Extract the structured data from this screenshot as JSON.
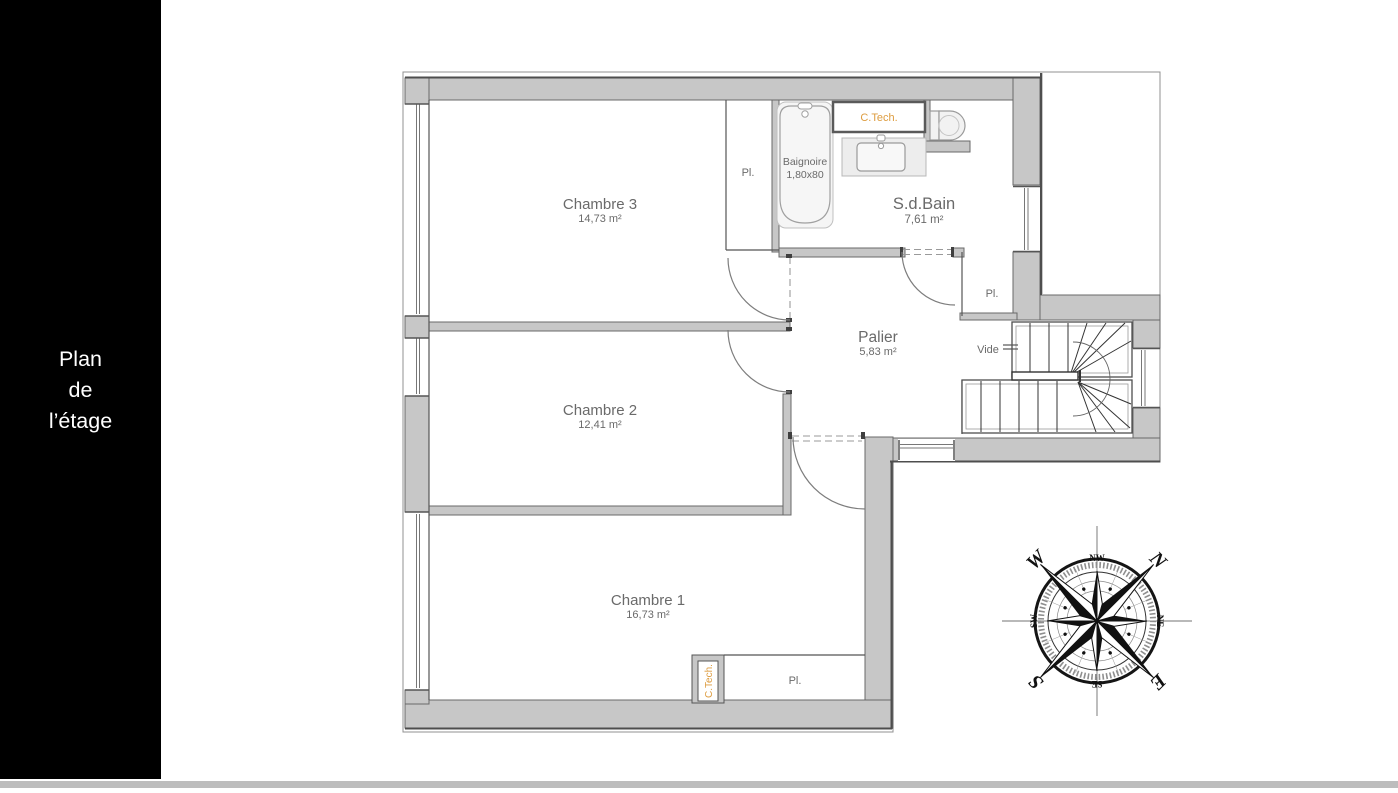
{
  "sidebar": {
    "lines": [
      "Plan",
      "de",
      "l’étage"
    ]
  },
  "plan": {
    "rooms": [
      {
        "name": "Chambre 3",
        "area": "14,73 m²"
      },
      {
        "name": "Chambre 2",
        "area": "12,41 m²"
      },
      {
        "name": "Chambre 1",
        "area": "16,73 m²"
      },
      {
        "name": "S.d.Bain",
        "area": "7,61 m²"
      },
      {
        "name": "Palier",
        "area": "5,83 m²"
      }
    ],
    "labels": {
      "closet": "Pl.",
      "void": "Vide",
      "tech": "C.Tech.",
      "bathtub": "Baignoire",
      "bathtub_size": "1,80x80"
    }
  },
  "compass": {
    "n": "N",
    "e": "E",
    "s": "S",
    "w": "W",
    "nw": "NW",
    "ne": "NE",
    "se": "SE",
    "sw": "SW"
  },
  "colors": {
    "wall_fill": "#c7c7c7",
    "wall_edge": "#4e4e4e",
    "label_text": "#6a6a6a",
    "accent_orange": "#dd9c3f",
    "sidebar_bg": "#000000",
    "sidebar_text": "#ffffff"
  }
}
